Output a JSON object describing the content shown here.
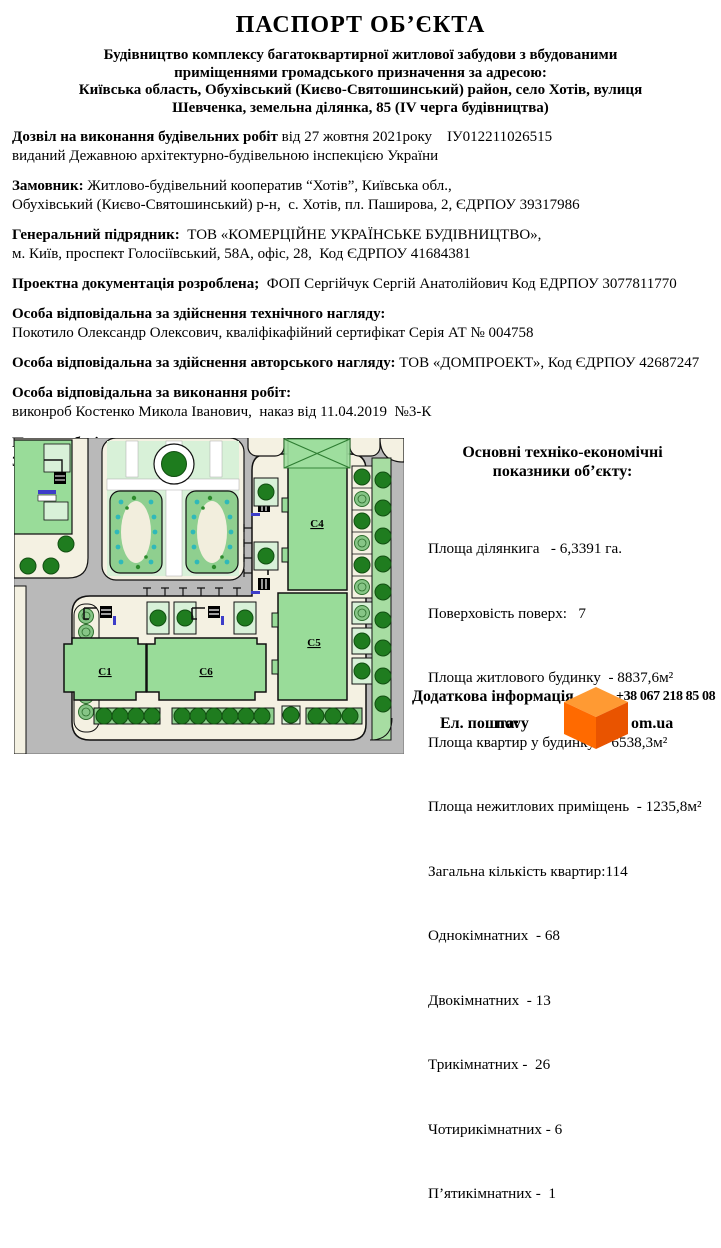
{
  "header": {
    "title": "ПАСПОРТ ОБ’ЄКТА",
    "address_lines": [
      "Будівництво комплексу багатоквартирної житлової забудови з вбудованими",
      "приміщеннями громадського призначення за адресою:",
      "Київська область, Обухівський (Києво-Святошинський) район, село Хотів, вулиця",
      "Шевченка, земельна ділянка, 85 (IV черга будівництва)"
    ]
  },
  "sections": {
    "permit": {
      "label": "Дозвіл на виконання будівельних робіт",
      "rest": " від 27 жовтня 2021року    ІУ012211026515",
      "line2": "виданий Дежавною архітектурно-будівельною інспекцією України"
    },
    "customer": {
      "label": "Замовник:",
      "rest": " Житлово-будівельний кооператив “Хотів”, Київська обл.,",
      "line2": "Обухівський (Києво-Святошинський) р-н,  с. Хотів, пл. Паширова, 2, ЄДРПОУ 39317986"
    },
    "contractor": {
      "label": "Генеральний підрядник:",
      "rest": "  ТОВ «КОМЕРЦІЙНЕ УКРАЇНСЬКЕ БУДІВНИЦТВО»,",
      "line2": "м. Київ, проспект Голосіївський, 58А, офіс, 28,  Код ЄДРПОУ 41684381"
    },
    "design": {
      "label": "Проектна документація розроблена;",
      "rest": "  ФОП Сергійчук Сергій Анатолійович Код ЕДРПОУ 3077811770"
    },
    "tech": {
      "label": "Особа відповідальна за здійснення технічного нагляду:",
      "line2": "Покотило Олександр Олексович, кваліфікафійний сертифікат Серія АТ № 004758"
    },
    "author": {
      "label": "Особа відповідальна за здійснення авторського нагляду:",
      "rest": " ТОВ «ДОМПРОЕКТ», Код ЄДРПОУ 42687247"
    },
    "works": {
      "label": "Особа відповідальна за виконання робіт:",
      "line2": "виконроб Костенко Микола Іванович,  наказ від 11.04.2019  №3-К"
    },
    "start": {
      "label": "Початок будівництва:"
    },
    "finish": {
      "label": "Закінчення будівництва:"
    }
  },
  "site_plan": {
    "labels": {
      "c1": "С1",
      "c6": "С6",
      "c5": "С5",
      "c4": "С4"
    },
    "colors": {
      "road": "#b9b9b9",
      "sidewalk": "#f4f1e2",
      "building": "#99dc99",
      "lawn": "#d8f1d8",
      "bed": "#8fcf8f",
      "tree": "#1f7c1f",
      "teal_dot": "#2fb9b9"
    }
  },
  "indicators": {
    "heading1": "Основні техніко-економічні",
    "heading2": "показники об’єкту:",
    "items": [
      "Площа ділянкига   - 6,3391 га.",
      "Поверховість поверх:   7",
      "Площа житлового будинку  - 8837,6м²",
      "Площа квартир у будинку  - 6538,3м²",
      "Площа нежитлових приміщень  - 1235,8м²",
      "Загальна кількість квартир:114",
      "Однокімнатних  - 68",
      "Двокімнатних  - 13",
      "Трикімнатних -  26",
      "Чотирикімнатних - 6",
      "П’ятикімнатних -  1"
    ]
  },
  "footer": {
    "extra_label": "Додаткова інформація",
    "phone": "+38 067 218 85 08",
    "email_label": "Ел. пошта:",
    "email_left": "novy",
    "email_right": "om.ua",
    "cube_colors": {
      "top": "#ff9a33",
      "left": "#ff6a00",
      "right": "#e95400"
    }
  }
}
